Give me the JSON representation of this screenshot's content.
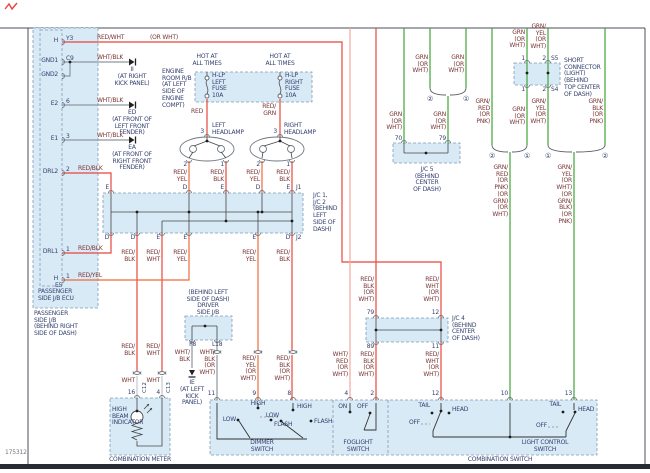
{
  "meta": {
    "id": "175312"
  },
  "colors": {
    "red": "#e8453c",
    "red_yel": "#ef6a3a",
    "pink": "#f2a8a2",
    "green": "#3fa53a",
    "gray": "#8e969e",
    "white_wire": "#c3c9d0",
    "box_fill": "#d9eaf7",
    "wire_label": "#7a3434",
    "comp_label": "#333f6e"
  },
  "ecu": {
    "pin_h_top": "H",
    "id_h_top": "Y3",
    "pin_gnd1": "GND1",
    "id_gnd1": "C9",
    "pin_gnd2": "GND2",
    "pin_e2": "E2",
    "id_e2": "6",
    "pin_e1": "E1",
    "id_e1": "3",
    "pin_drl2": "DRL2",
    "id_drl2": "2",
    "pin_drl1": "DRL1",
    "id_drl1": "1",
    "pin_h_bot": "H",
    "id_h_bot": "1",
    "id_h_bot2": "E5",
    "ecu_caption": "PASSENGER\nSIDE J/B ECU",
    "jb_caption": "PASSENGER\nSIDE J/B\n(BEHIND RIGHT\nSIDE OF DASH)"
  },
  "grounds": {
    "g1": "II",
    "g1_loc": "(AT RIGHT\nKICK PANEL)",
    "g2": "ED",
    "g2_loc": "(AT FRONT OF\nLEFT FRONT\nFENDER)",
    "g3": "EA",
    "g3_loc": "(AT FRONT OF\nRIGHT FRONT\nFENDER)",
    "g4": "IE",
    "g4_loc": "(AT LEFT\nKICK\nPANEL)"
  },
  "engine_room": {
    "caption": "ENGINE\nROOM R/B\n(AT LEFT\nSIDE OF\nENGINE\nCOMPT)",
    "hot_left": "HOT AT\nALL TIMES",
    "hot_right": "HOT AT\nALL TIMES",
    "fuse_left": "H-LP\nLEFT\nFUSE\n10A",
    "fuse_right": "H-LP\nRIGHT\nFUSE\n10A"
  },
  "headlamps": {
    "left": "LEFT\nHEADLAMP",
    "right": "RIGHT\nHEADLAMP",
    "l3": "3",
    "l2": "2",
    "l1": "1",
    "r3": "3",
    "r2": "2",
    "r1": "1"
  },
  "jc12": {
    "caption": "J/C 1,\nJ/C 2\n(BEHIND\nLEFT\nSIDE OF\nDASH)",
    "j1": "J1",
    "j2": "J2",
    "top": [
      "E",
      "D",
      "E",
      "D",
      "E"
    ],
    "bottom": [
      "D",
      "D",
      "E",
      "E",
      "E",
      "D"
    ]
  },
  "jc4": {
    "caption": "J/C 4\n(BEHIND\nCENTER\nOF DASH)",
    "t1": "79",
    "t2": "12",
    "b1": "89",
    "b2": "11"
  },
  "jc5": {
    "caption": "J/C 5\n(BEHIND\nCENTER\nOF DASH)",
    "p1": "70",
    "p2": "79"
  },
  "short_conn": {
    "caption": "SHORT\nCONNECTOR\n(LIGHT)\n(BEHIND\nTOP CENTER\nOF DASH)",
    "t1": "1",
    "t2": "2",
    "s5": "S5",
    "b1": "1",
    "b2": "2",
    "s4": "S4"
  },
  "driver_jb": {
    "caption": "(BEHIND LEFT\nSIDE OF DASH)\nDRIVER\nSIDE J/B",
    "f8": "F8",
    "l18": "L18"
  },
  "meter": {
    "caption": "COMBINATION METER",
    "indicator": "HIGH\nBEAM\nINDICATOR",
    "p16": "16",
    "p4": "4",
    "c12": "C12",
    "c13": "C13"
  },
  "cswitch": {
    "caption": "COMBINATION SWITCH",
    "dimmer": "DIMMER\nSWITCH",
    "fog": "FOGLIGHT\nSWITCH",
    "lc": "LIGHT CONTROL\nSWITCH",
    "high1": "HIGH",
    "low1": "LOW",
    "flash1": "FLASH",
    "high2": "HIGH",
    "low2": "LOW",
    "flash2": "FLASH",
    "on": "ON",
    "off_fog": "OFF",
    "tail1": "TAIL",
    "head1": "HEAD",
    "off1": "OFF",
    "tail2": "TAIL",
    "head2": "HEAD",
    "off2": "OFF",
    "p11": "11",
    "p9": "9",
    "p8": "8",
    "p4": "4",
    "p2": "2",
    "p12": "12",
    "p10": "10",
    "p13": "13"
  },
  "wires": {
    "redwht": "RED/WHT",
    "orwht": "(OR WHT)",
    "whtblk1": "WHT/BLK",
    "whtblk2": "WHT/BLK",
    "whtblk3": "WHT/BLK",
    "redblk_drl2": "RED/BLK",
    "redblk_drl1": "RED/BLK",
    "redyel_h": "RED/YEL",
    "red": "RED",
    "redgrn": "RED/\nGRN",
    "hl_l2": "RED/\nYEL",
    "hl_l1": "RED/\nBLK",
    "hl_r2": "RED/\nYEL",
    "hl_r1": "RED/\nBLK",
    "o137": "RED/\nBLK",
    "o162": "RED/\nWHT",
    "o189": "RED/\nYEL",
    "o258": "RED/\nYEL",
    "o292": "RED/\nBLK",
    "m137": "RED/\nBLK",
    "m162": "RED/\nWHT",
    "wht1": "WHT",
    "wht2": "WHT",
    "d258": "RED/\nYEL\n(OR\nWHT)",
    "d292": "RED/\nBLK\n(OR\nWHT)",
    "f8": "WHT/\nBLK",
    "l18": "WHT/\nBLK\n(OR\nWHT)",
    "w350": "WHT/\nRED\n(OR\nWHT)",
    "w376a": "RED/\nBLK\n(OR\nWHT)",
    "w376b": "RED/\nBLK\n(OR\nWHT)",
    "w441a": "RED/\nWHT\n(OR\nWHT)",
    "w441b": "RED/\nWHT\n(OR\nWHT)",
    "g404": "GRN\n(OR\nWHT)",
    "g430": "GRN\n(OR\nWHT)",
    "g466": "GRN\n(OR\nWHT)",
    "g448": "GRN\n(OR\nWHT)",
    "g527a": "GRN\n(OR\nWHT)",
    "g548a": "GRN/\nYEL\n(OR\nWHT)",
    "g492": "GRN/\nRED\n(OR\nPNK)",
    "g527b": "GRN\n(OR\nWHT)",
    "g548b": "GRN/\nYEL\n(OR\nWHT)",
    "g605": "GRN/\nBLK\n(OR\nPNK)",
    "g510": "GRN/\nRED\n(OR\nPNK)\n(OR\nGRN)\n(OR\nWHT)",
    "g574": "GRN/\nYEL\n(OR\nWHT)\n(OR\nGRN/\nBLK)\n(OR\nPNK)"
  },
  "splices": {
    "s2a": "②",
    "s1a": "①",
    "s2b": "②",
    "s1b": "①",
    "s1c": "①",
    "s2c": "②"
  }
}
